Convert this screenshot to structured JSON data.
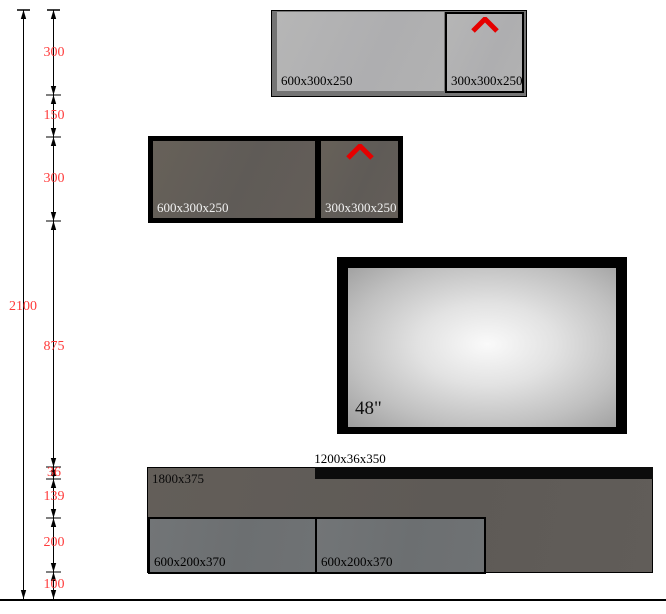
{
  "dimension_labels": {
    "overall": "2100",
    "segments": [
      "300",
      "150",
      "300",
      "875",
      "36",
      "139",
      "200",
      "100"
    ]
  },
  "upper_cabinet": {
    "left_unit_label": "600x300x250",
    "right_unit_label": "300x300x250"
  },
  "middle_cabinet": {
    "left_unit_label": "600x300x250",
    "right_unit_label": "300x300x250"
  },
  "tv": {
    "size_label": "48\""
  },
  "base_unit": {
    "shelf_label": "1200x36x350",
    "panel_label": "1800x375",
    "left_drawer_label": "600x200x370",
    "right_drawer_label": "600x200x370"
  },
  "colors": {
    "dimension_text": "#ff3b3b",
    "door_arrow_red": "#e60000",
    "light_panel": "#b2b2b2",
    "frame_gray": "#747474",
    "dark_panel": "#615d59",
    "drawer_gray": "#6f7274"
  }
}
